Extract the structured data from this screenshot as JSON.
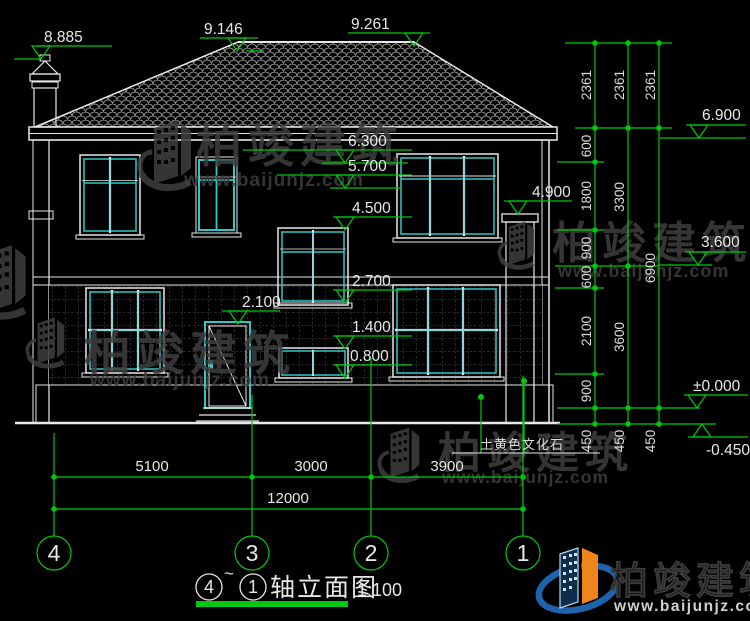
{
  "colors": {
    "background": "#000000",
    "line_white": "#e8e8e8",
    "glazing_cyan": "#2fc7c7",
    "dimension_green": "#00c80c",
    "watermark_gray": "#3f3f3f",
    "logo_blue": "#1d64ad",
    "logo_orange": "#f08519"
  },
  "elevations": {
    "chimney_top": "8.885",
    "ridge_left": "9.146",
    "ridge_right": "9.261",
    "eave_soffit": "6.300",
    "window2_top": "5.700",
    "stair_window_top": "4.500",
    "stair_window_sill": "2.700",
    "door_top": "2.100",
    "small_window_top": "1.400",
    "small_window_sill": "0.800",
    "right_chimney_top": "4.900",
    "eave_right": "6.900",
    "second_floor_right": "3.600",
    "ground_floor": "±0.000",
    "outdoor_ground": "-0.450"
  },
  "right_dims": {
    "col1": [
      "2361",
      "600",
      "1800",
      "900",
      "600",
      "2100",
      "900",
      "450"
    ],
    "col2": [
      "2361",
      "3300",
      "3600",
      "450"
    ],
    "col3": [
      "2361",
      "6900",
      "450"
    ]
  },
  "bottom_dims": {
    "segments": [
      "5100",
      "3000",
      "3900"
    ],
    "overall": "12000"
  },
  "axes": [
    "4",
    "3",
    "2",
    "1"
  ],
  "title": {
    "from_axis": "4",
    "tilde": "~",
    "to_axis": "1",
    "name": "轴立面图",
    "scale": "1:100"
  },
  "labels": {
    "stone": "土黄色文化石"
  },
  "watermark": {
    "brand": "柏竣建筑",
    "url": "www.baijunjz.com"
  },
  "logo": {
    "brand": "柏竣建筑",
    "url": "www.baijunjz.com"
  }
}
